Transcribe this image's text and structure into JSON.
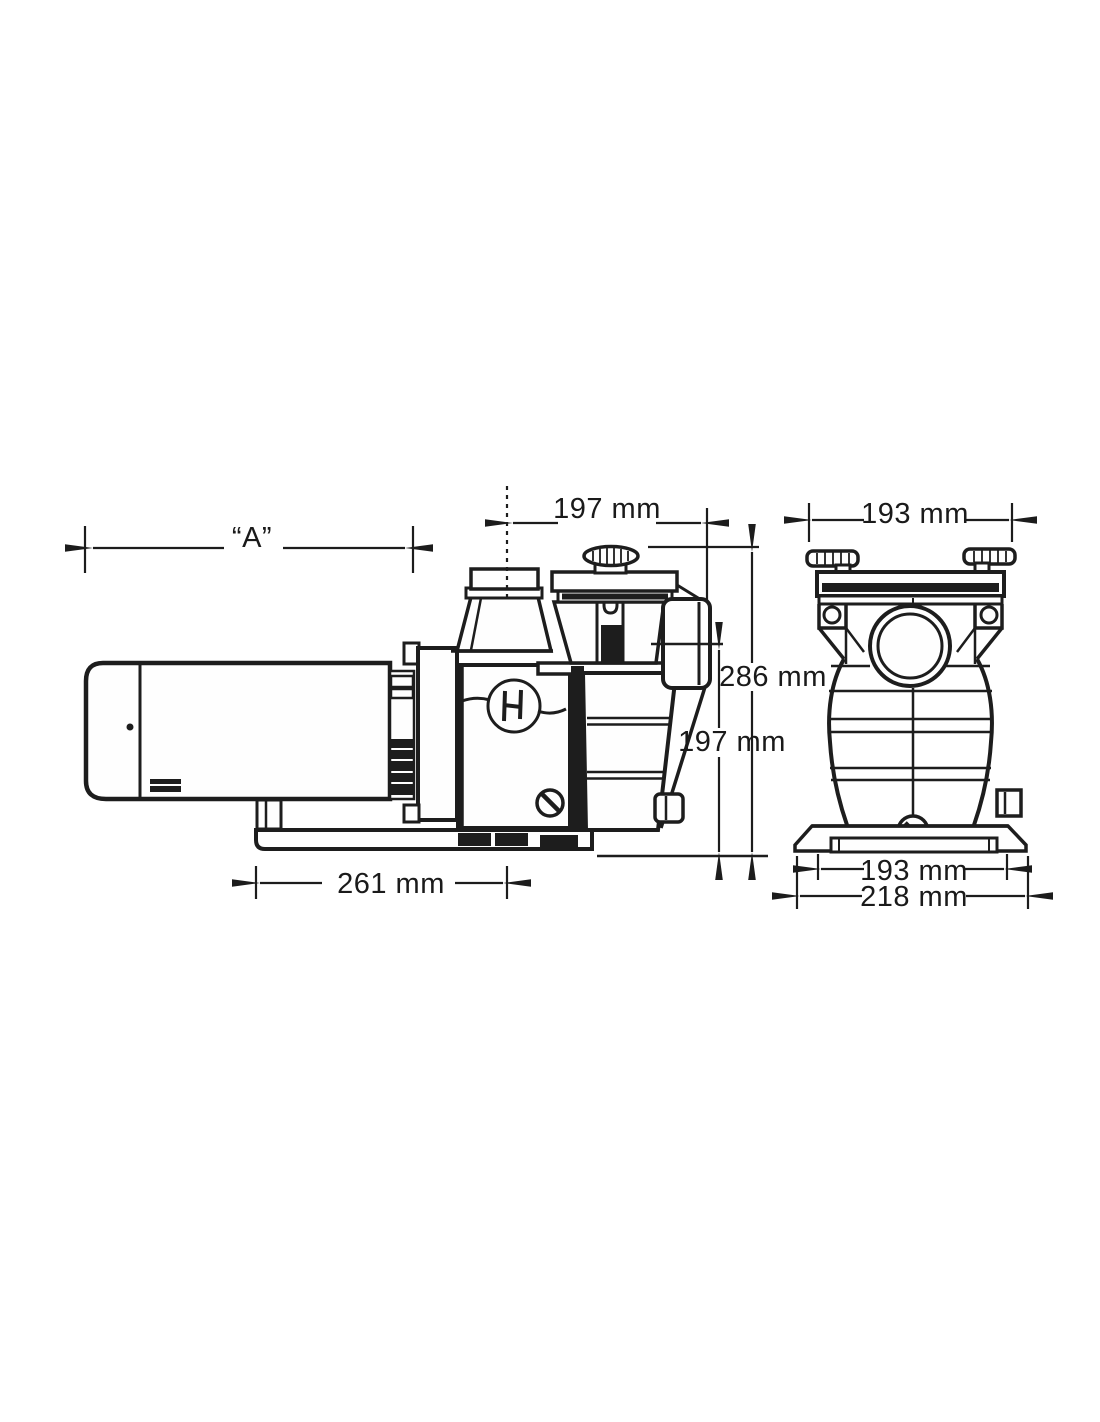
{
  "page": {
    "background_color": "#ffffff",
    "ink_color": "#1d1d1d"
  },
  "drawing": {
    "logo_icon": "hayward-h",
    "dims": {
      "motor_length": "“A”",
      "top_width_side": "197 mm",
      "top_width_front": "193 mm",
      "overall_height": "286 mm",
      "port_center_height": "197 mm",
      "base_length": "261 mm",
      "base_width_inner": "193 mm",
      "base_width_overall": "218 mm"
    }
  }
}
